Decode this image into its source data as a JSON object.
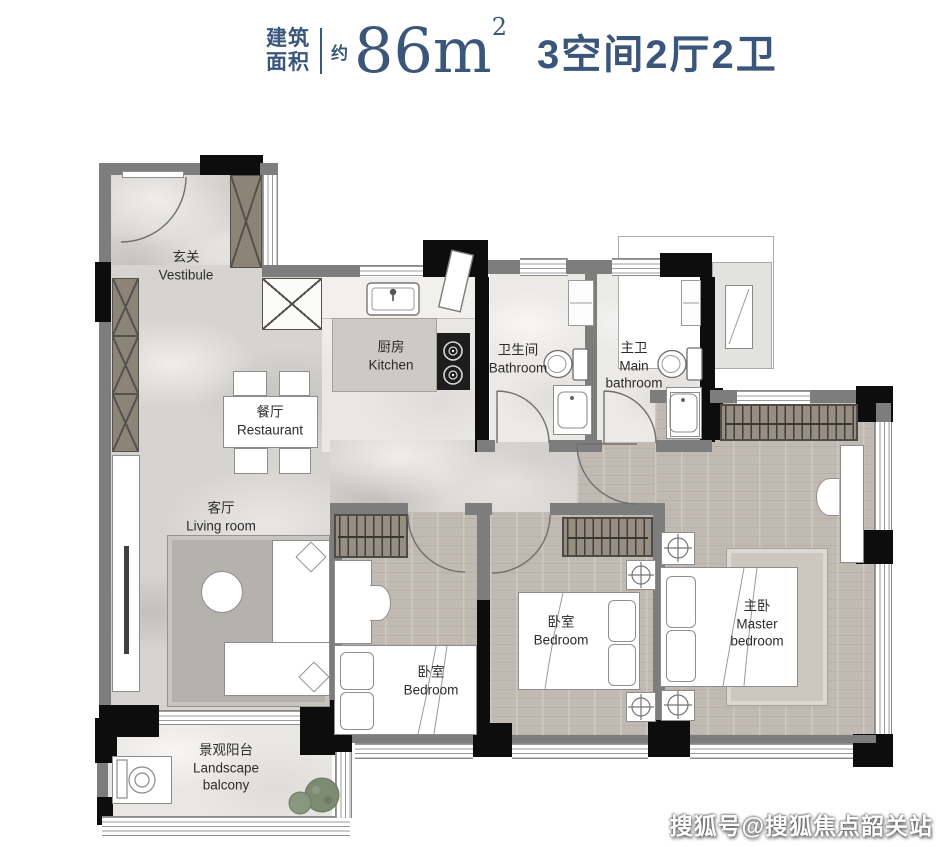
{
  "header": {
    "area_label_top": "建筑",
    "area_label_bottom": "面积",
    "approx_label": "约",
    "area_value": "86m",
    "area_exponent": "2",
    "layout_text": "3空间2厅2卫",
    "accent_color": "#3a567b"
  },
  "rooms": {
    "vestibule": {
      "zh": "玄关",
      "en": "Vestibule"
    },
    "kitchen": {
      "zh": "厨房",
      "en": "Kitchen"
    },
    "bathroom": {
      "zh": "卫生间",
      "en": "Bathroom"
    },
    "main_bathroom": {
      "zh": "主卫",
      "en": "Main bathroom"
    },
    "dining": {
      "zh": "餐厅",
      "en": "Restaurant"
    },
    "living": {
      "zh": "客厅",
      "en": "Living room"
    },
    "bedroom_a": {
      "zh": "卧室",
      "en": "Bedroom"
    },
    "bedroom_b": {
      "zh": "卧室",
      "en": "Bedroom"
    },
    "master_bedroom": {
      "zh": "主卧",
      "en": "Master bedroom"
    },
    "balcony": {
      "zh": "景观阳台",
      "en": "Landscape balcony"
    }
  },
  "watermark": {
    "text": "搜狐号@搜狐焦点韶关站"
  }
}
